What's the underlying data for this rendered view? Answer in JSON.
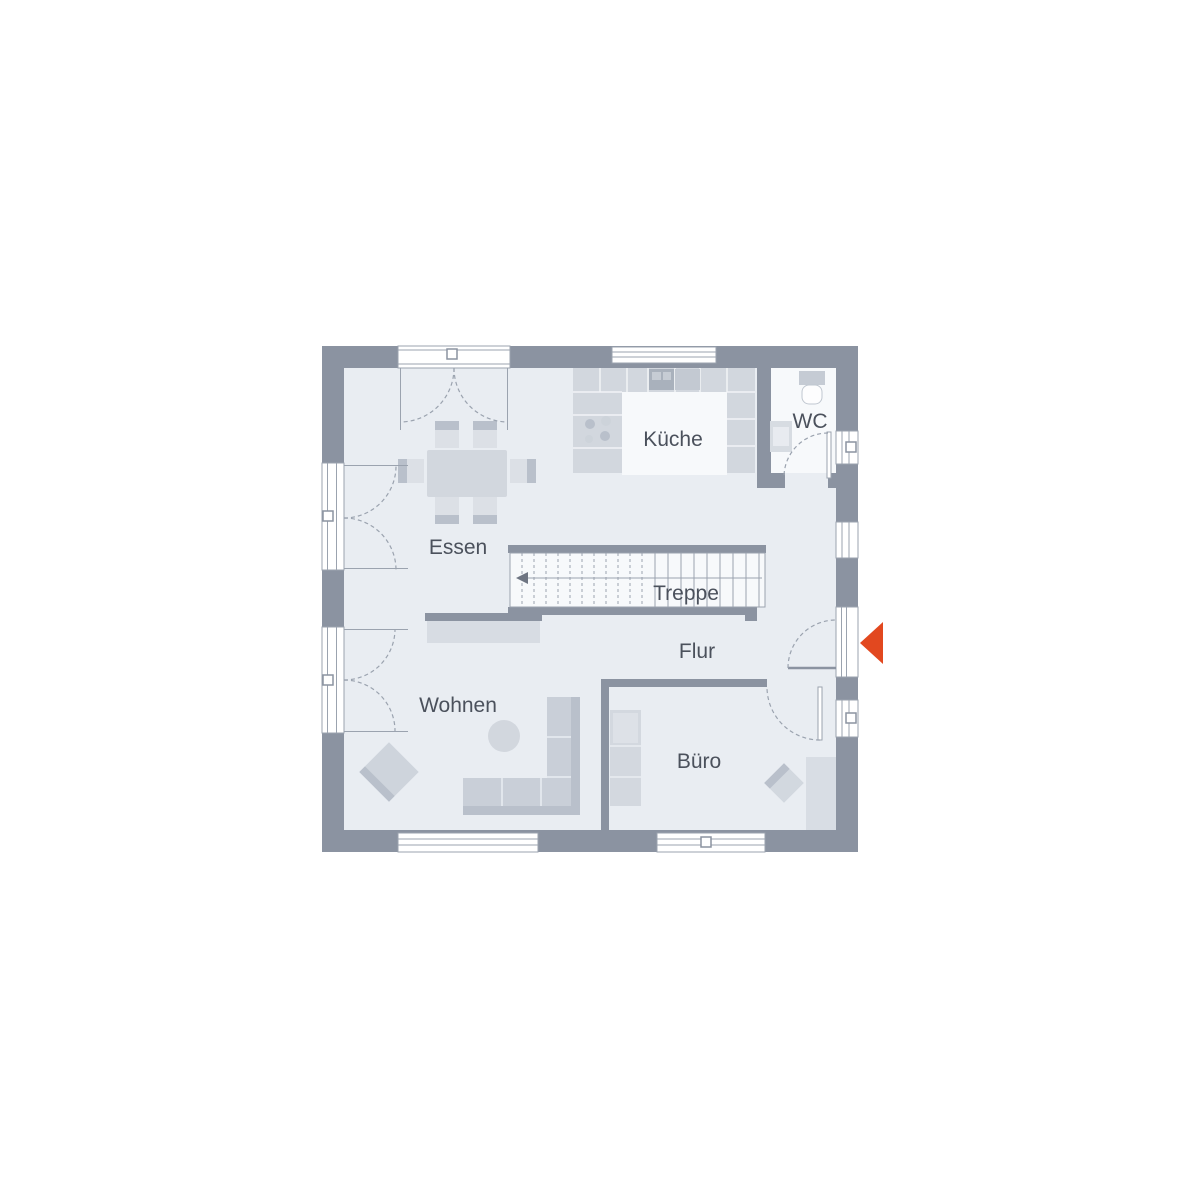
{
  "floorplan": {
    "labels": {
      "kueche": "Küche",
      "wc": "WC",
      "essen": "Essen",
      "treppe": "Treppe",
      "flur": "Flur",
      "wohnen": "Wohnen",
      "buero": "Büro"
    },
    "rooms": [
      {
        "id": "kueche",
        "label": "Küche"
      },
      {
        "id": "wc",
        "label": "WC"
      },
      {
        "id": "essen",
        "label": "Essen"
      },
      {
        "id": "treppe",
        "label": "Treppe"
      },
      {
        "id": "flur",
        "label": "Flur"
      },
      {
        "id": "wohnen",
        "label": "Wohnen"
      },
      {
        "id": "buero",
        "label": "Büro"
      }
    ],
    "entrance_marker": "entrance-arrow",
    "colors": {
      "wall": "#8b93a1",
      "floor": "#e9edf2",
      "floor_light": "#f7f9fb",
      "furniture": "#d2d7de",
      "furniture_mid": "#c9cfd8",
      "furniture_dark": "#b9c0cb",
      "appliance_dark": "#a9b1bc",
      "line": "#9ba3af",
      "label_text": "#4b515c",
      "entrance_arrow": "#e2481f",
      "stair_arrow": "#6e7582",
      "white": "#ffffff"
    }
  }
}
